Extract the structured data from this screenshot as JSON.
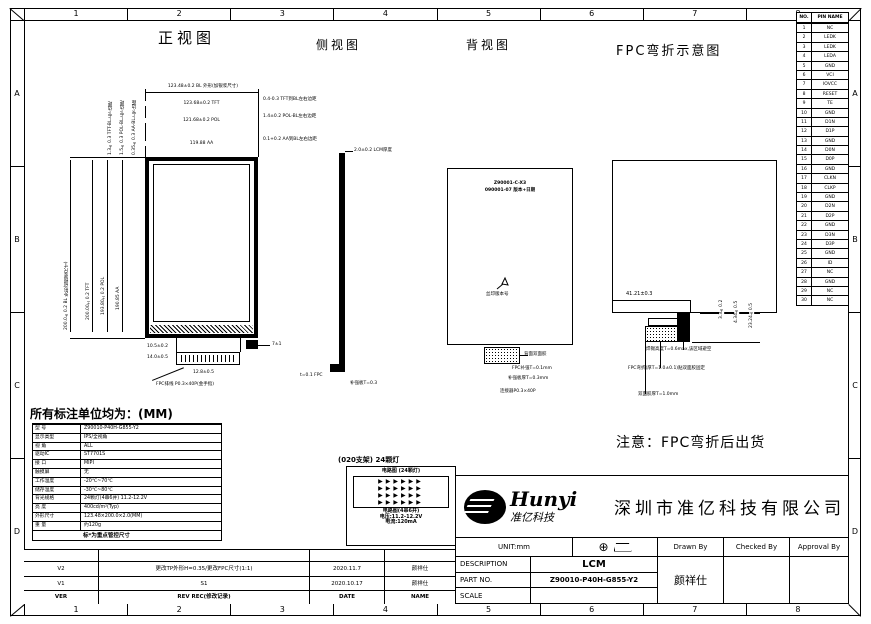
{
  "sheet": {
    "zones_top": [
      "1",
      "2",
      "3",
      "4",
      "5",
      "6",
      "7",
      "8"
    ],
    "zones_bottom": [
      "1",
      "2",
      "3",
      "4",
      "5",
      "6",
      "7",
      "8"
    ],
    "zones_left": [
      "A",
      "B",
      "C",
      "D"
    ],
    "zones_right": [
      "A",
      "B",
      "C",
      "D"
    ]
  },
  "titles": {
    "front": "正视图",
    "side": "侧视图",
    "back": "背视图",
    "fpc": "FPC弯折示意图"
  },
  "front": {
    "dim_bl": "123.48±0.2 BL 外形(加银浆尺寸)",
    "dims_top": [
      "123.68±0.2 TFT",
      "121.68±0.2 POL",
      "119.88 AA"
    ],
    "dims_right": [
      "0.4-0.3 TFT到BL左右边距",
      "1.4±0.2 POL-BL左右边距",
      "0.1+0.2 AA到BL左右边距"
    ],
    "dims_left": [
      "200.0±0.2 BL 外形(加银浆尺寸)",
      "200.00±0.2 TFT",
      "193.80±0.2 POL",
      "190.85 AA"
    ],
    "dims_left_top": [
      "1.3±0.3 TFT-BL上下边距",
      "1.5±0.3 POL-BL上下边距",
      "0.35±0.3 AA-BL上下边距"
    ],
    "dims_bottom": {
      "d1": "10.5±0.2",
      "d2": "14.0±0.5",
      "d3": "12.8±0.5",
      "d4": "7±1"
    },
    "fpc_label": "FPC排线 P0.3×40P(金手指)"
  },
  "side": {
    "thickness": "2.0±0.2 LCM厚度",
    "callouts": [
      "t=0.1 FPC",
      "补强板T=0.3"
    ]
  },
  "back": {
    "silk1": "Z90001-C-X3",
    "silk2": "090001-07 版本+日期",
    "arrow_label": "丝印版本号",
    "callouts": [
      "背面双面胶",
      "FPC补强T=0.1mm",
      "补强板厚T=0.3mm",
      "连接器P0.3×40P"
    ]
  },
  "fpc": {
    "dim_w": "41.21±0.3",
    "dims_v": [
      "3.3±0.2",
      "4.34±0.5",
      "23.24±0.5"
    ],
    "callouts": [
      "焊锡高度T=0.6max,该区域避空",
      "FPC弯折(厚T=1.0±0.1)贴双面胶固定",
      "双面胶厚T=1.0mm"
    ]
  },
  "note": "注意：FPC弯折后出货",
  "units_heading": "所有标注单位均为：(MM)",
  "spec_table": {
    "rows": [
      {
        "label": "型 号",
        "value": "Z90010-P40H-G855-Y2"
      },
      {
        "label": "显示类型",
        "value": "IPS/全视角"
      },
      {
        "label": "视 角",
        "value": "ALL"
      },
      {
        "label": "驱动IC",
        "value": "ST7701S"
      },
      {
        "label": "接 口",
        "value": "MIPI"
      },
      {
        "label": "触摸屏",
        "value": "无"
      },
      {
        "label": "工作温度",
        "value": "-20℃~70℃"
      },
      {
        "label": "储存温度",
        "value": "-30℃~80℃"
      },
      {
        "label": "背光规格",
        "value": "24颗灯(4串6并) 11.2-12.2V"
      },
      {
        "label": "亮 度",
        "value": "400cd/m²(Typ)"
      },
      {
        "label": "外形尺寸",
        "value": "123.48×200.0×2.0(MM)"
      },
      {
        "label": "重 量",
        "value": "约120g"
      }
    ],
    "note": "标*为重点管控尺寸"
  },
  "led_box": {
    "outer_title": "(020支架) 24颗灯",
    "inner_title": "电路图 (24颗灯)",
    "diode_rows": [
      "▶▶▶▶▶▶",
      "▶▶▶▶▶▶",
      "▶▶▶▶▶▶",
      "▶▶▶▶▶▶"
    ],
    "lines": [
      "电路图(4串6并)",
      "电压:11.2-12.2V",
      "电流:120mA"
    ]
  },
  "pin_table": {
    "headers": {
      "no": "NO.",
      "name": "PIN NAME"
    },
    "rows": [
      {
        "no": "1",
        "name": "NC"
      },
      {
        "no": "2",
        "name": "LEDK"
      },
      {
        "no": "3",
        "name": "LEDK"
      },
      {
        "no": "4",
        "name": "LEDA"
      },
      {
        "no": "5",
        "name": "GND"
      },
      {
        "no": "6",
        "name": "VCI"
      },
      {
        "no": "7",
        "name": "IOVCC"
      },
      {
        "no": "8",
        "name": "RESET"
      },
      {
        "no": "9",
        "name": "TE"
      },
      {
        "no": "10",
        "name": "GND"
      },
      {
        "no": "11",
        "name": "D1N"
      },
      {
        "no": "12",
        "name": "D1P"
      },
      {
        "no": "13",
        "name": "GND"
      },
      {
        "no": "14",
        "name": "D0N"
      },
      {
        "no": "15",
        "name": "D0P"
      },
      {
        "no": "16",
        "name": "GND"
      },
      {
        "no": "17",
        "name": "CLKN"
      },
      {
        "no": "18",
        "name": "CLKP"
      },
      {
        "no": "19",
        "name": "GND"
      },
      {
        "no": "20",
        "name": "D2N"
      },
      {
        "no": "21",
        "name": "D2P"
      },
      {
        "no": "22",
        "name": "GND"
      },
      {
        "no": "23",
        "name": "D3N"
      },
      {
        "no": "24",
        "name": "D3P"
      },
      {
        "no": "25",
        "name": "GND"
      },
      {
        "no": "26",
        "name": "ID"
      },
      {
        "no": "27",
        "name": "NC"
      },
      {
        "no": "28",
        "name": "GND"
      },
      {
        "no": "29",
        "name": "NC"
      },
      {
        "no": "30",
        "name": "NC"
      }
    ]
  },
  "revision_table": {
    "rows": [
      {
        "ver": "V2",
        "desc": "更改TP外形H=0.35/更改FPC尺寸(1:1)",
        "date": "2020.11.7",
        "name": "颜祥仕"
      },
      {
        "ver": "V1",
        "desc": "S1",
        "date": "2020.10.17",
        "name": "颜祥仕"
      }
    ],
    "header": {
      "ver": "VER",
      "desc": "REV REC(修改记录)",
      "date": "DATE",
      "name": "NAME"
    }
  },
  "title_block": {
    "logo_main": "Hunyi",
    "logo_sub": "准亿科技",
    "company": "深圳市准亿科技有限公司",
    "unit": "UNIT:mm",
    "drawn_by": "Drawn By",
    "checked_by": "Checked By",
    "approval_by": "Approval By",
    "desc_label": "DESCRIPTION",
    "desc_value": "LCM",
    "part_label": "PART NO.",
    "part_value": "Z90010-P40H-G855-Y2",
    "scale_label": "SCALE",
    "scale_value": "",
    "drawn_name": "颜祥仕"
  }
}
